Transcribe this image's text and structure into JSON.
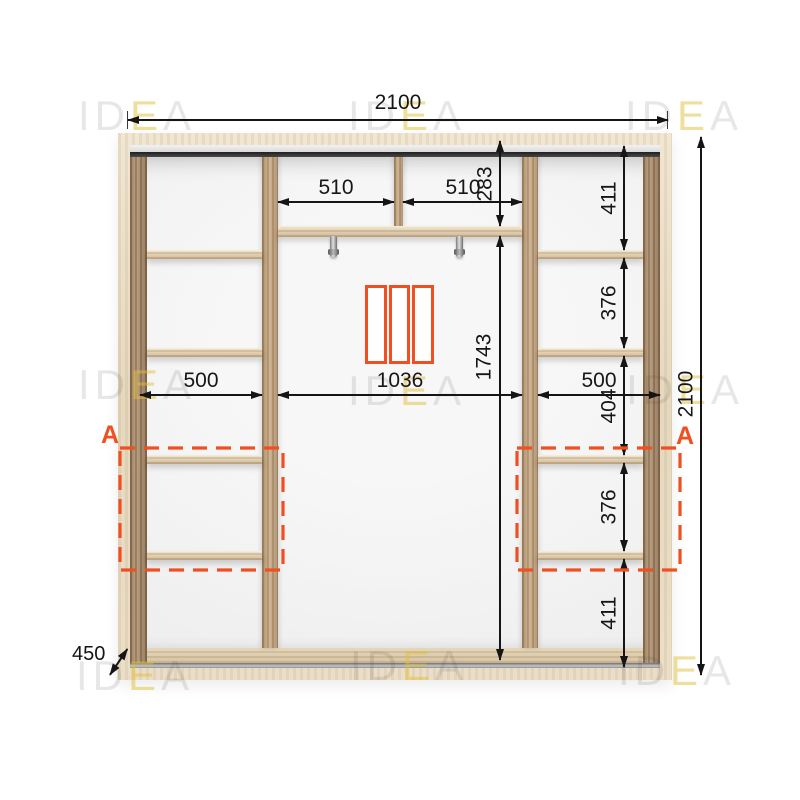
{
  "watermark": {
    "part1": "ID",
    "part2": "E",
    "part3": "A"
  },
  "colors": {
    "accent_orange": "#F04F21",
    "dimension_line": "#151515",
    "wood_light": "#E7DAC1",
    "wood_medium": "#A98B68"
  },
  "dimensions": {
    "overall_width": "2100",
    "overall_height": "2100",
    "depth": "450",
    "top_shelf_left_width": "510",
    "top_shelf_right_width": "510",
    "top_section_height": "283",
    "center_opening_width": "1036",
    "center_opening_height": "1743",
    "left_column_width": "500",
    "right_column_width": "500",
    "right_column_heights": [
      "411",
      "376",
      "404",
      "376",
      "411"
    ]
  },
  "annotations": {
    "section_marker_left": "A",
    "section_marker_right": "A"
  }
}
